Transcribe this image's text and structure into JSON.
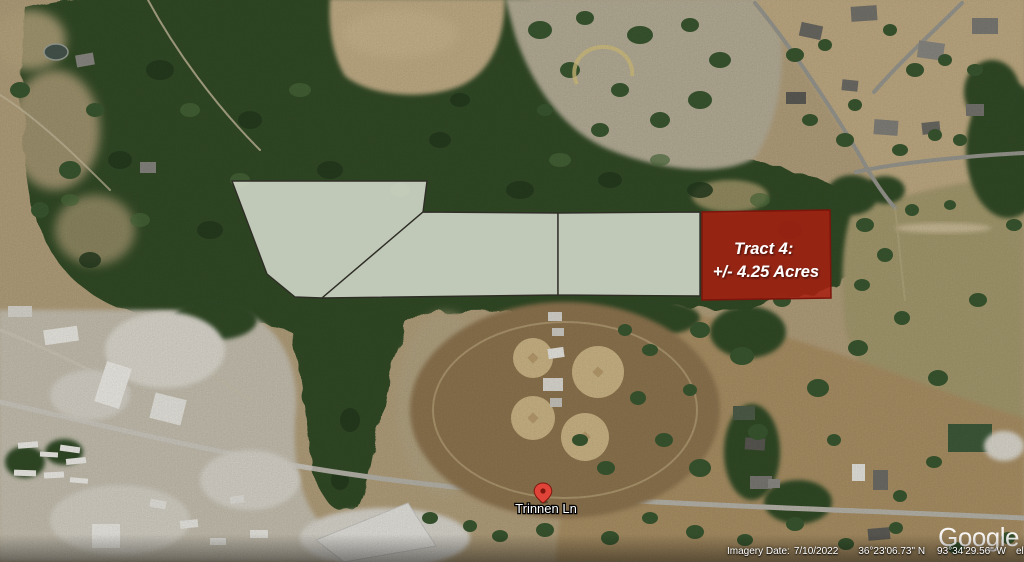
{
  "map": {
    "road_label": "Trinnen Ln",
    "tract4": {
      "label_line1": "Tract 4:",
      "label_line2": "+/- 4.25 Acres"
    }
  },
  "colors": {
    "tract_light_fill": "#dde2d4",
    "tract_light_outline": "#2e2e27",
    "tract4_fill": "#a81f10",
    "tract4_outline": "#7c150b",
    "tract4_label": "#ffffff",
    "pin_red": "#e04337",
    "pin_dark": "#7e180f",
    "road_label_color": "#ffffff",
    "forest_green": "#314c28",
    "ground_tan": "#b3a07c"
  },
  "watermark": {
    "logo_text": "Google"
  },
  "status_bar": {
    "imagery_date_label": "Imagery Date:",
    "imagery_date": "7/10/2022",
    "latitude": "36°23'06.73\" N",
    "longitude": "93°34'29.56\" W",
    "elevation_label": "elev",
    "elevation": "1199 ft",
    "eye_alt_label": "eye alt"
  }
}
